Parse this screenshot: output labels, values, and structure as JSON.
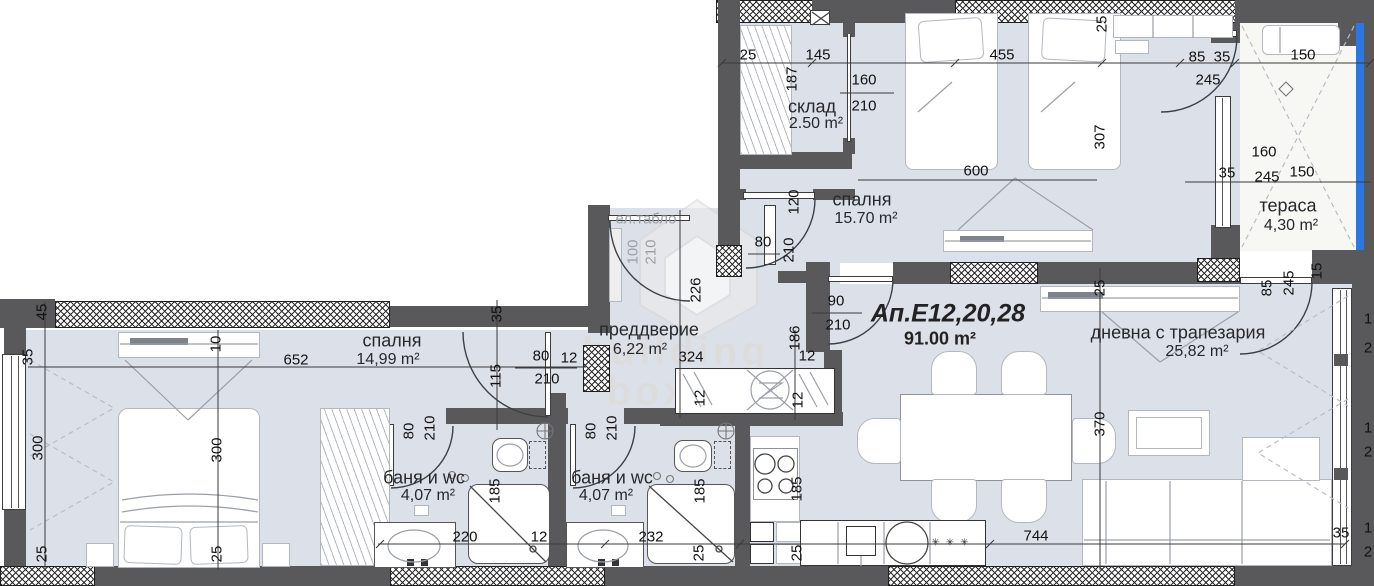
{
  "plan": {
    "apartment": {
      "label": "Ап.Е12,20,28",
      "area": "91.00 m²"
    },
    "rooms": [
      {
        "name": "склад",
        "area": "2.50 m²",
        "x": 812,
        "y": 107,
        "ax": 816,
        "ay": 124
      },
      {
        "name": "спалня",
        "area": "15.70 m²",
        "x": 862,
        "y": 200,
        "ax": 866,
        "ay": 219
      },
      {
        "name": "тераса",
        "area": "4,30 m²",
        "x": 1288,
        "y": 206,
        "ax": 1291,
        "ay": 226
      },
      {
        "name": "преддверие",
        "area": "6,22 m²",
        "x": 649,
        "y": 330,
        "ax": 640,
        "ay": 350
      },
      {
        "name": "дневна с трапезария",
        "area": "25,82 m²",
        "x": 1178,
        "y": 333,
        "ax": 1197,
        "ay": 352
      },
      {
        "name": "спалня",
        "area": "14,99 m²",
        "x": 392,
        "y": 341,
        "ax": 388,
        "ay": 360
      },
      {
        "name": "баня и wc",
        "area": "4,07 m²",
        "x": 424,
        "y": 478,
        "ax": 428,
        "ay": 496
      },
      {
        "name": "баня и wc",
        "area": "4,07 m²",
        "x": 612,
        "y": 478,
        "ax": 606,
        "ay": 496
      }
    ],
    "annotations": [
      {
        "text": "ел.табло",
        "x": 646,
        "y": 219
      }
    ],
    "watermark": {
      "line1": "building",
      "line2": "box"
    },
    "dimensions": [
      {
        "t": "25",
        "x": 748,
        "y": 55
      },
      {
        "t": "145",
        "x": 818,
        "y": 55
      },
      {
        "t": "187",
        "x": 792,
        "y": 79,
        "r": 1
      },
      {
        "t": "160",
        "x": 864,
        "y": 80
      },
      {
        "t": "210",
        "x": 864,
        "y": 106
      },
      {
        "t": "455",
        "x": 1002,
        "y": 55
      },
      {
        "t": "600",
        "x": 976,
        "y": 171
      },
      {
        "t": "85",
        "x": 1197,
        "y": 57
      },
      {
        "t": "35",
        "x": 1222,
        "y": 57
      },
      {
        "t": "245",
        "x": 1208,
        "y": 80
      },
      {
        "t": "150",
        "x": 1303,
        "y": 55
      },
      {
        "t": "25",
        "x": 1102,
        "y": 24,
        "r": 1
      },
      {
        "t": "307",
        "x": 1100,
        "y": 137,
        "r": 1
      },
      {
        "t": "160",
        "x": 1264,
        "y": 152
      },
      {
        "t": "35",
        "x": 1227,
        "y": 173
      },
      {
        "t": "245",
        "x": 1267,
        "y": 177
      },
      {
        "t": "150",
        "x": 1302,
        "y": 172
      },
      {
        "t": "120",
        "x": 794,
        "y": 202,
        "r": 1
      },
      {
        "t": "80",
        "x": 763,
        "y": 242
      },
      {
        "t": "210",
        "x": 789,
        "y": 250,
        "r": 1
      },
      {
        "t": "226",
        "x": 696,
        "y": 290,
        "r": 1
      },
      {
        "t": "100",
        "x": 633,
        "y": 252,
        "r": 1,
        "g": 1
      },
      {
        "t": "210",
        "x": 651,
        "y": 252,
        "r": 1,
        "g": 1
      },
      {
        "t": "90",
        "x": 836,
        "y": 301
      },
      {
        "t": "210",
        "x": 838,
        "y": 325
      },
      {
        "t": "186",
        "x": 795,
        "y": 338,
        "r": 1
      },
      {
        "t": "12",
        "x": 807,
        "y": 356
      },
      {
        "t": "12",
        "x": 798,
        "y": 400,
        "r": 1
      },
      {
        "t": "324",
        "x": 691,
        "y": 357
      },
      {
        "t": "12",
        "x": 700,
        "y": 398,
        "r": 1
      },
      {
        "t": "25",
        "x": 1100,
        "y": 288,
        "r": 1
      },
      {
        "t": "370",
        "x": 1100,
        "y": 424,
        "r": 1
      },
      {
        "t": "85",
        "x": 1267,
        "y": 288,
        "r": 1
      },
      {
        "t": "245",
        "x": 1289,
        "y": 283,
        "r": 1
      },
      {
        "t": "15",
        "x": 1317,
        "y": 271,
        "r": 1
      },
      {
        "t": "652",
        "x": 296,
        "y": 360
      },
      {
        "t": "10",
        "x": 216,
        "y": 344,
        "r": 1
      },
      {
        "t": "45",
        "x": 42,
        "y": 312,
        "r": 1
      },
      {
        "t": "35",
        "x": 28,
        "y": 357,
        "r": 1
      },
      {
        "t": "300",
        "x": 38,
        "y": 448,
        "r": 1
      },
      {
        "t": "300",
        "x": 217,
        "y": 450,
        "r": 1
      },
      {
        "t": "25",
        "x": 42,
        "y": 554,
        "r": 1
      },
      {
        "t": "25",
        "x": 217,
        "y": 554,
        "r": 1
      },
      {
        "t": "35",
        "x": 497,
        "y": 314,
        "r": 1
      },
      {
        "t": "115",
        "x": 496,
        "y": 376,
        "r": 1
      },
      {
        "t": "80",
        "x": 541,
        "y": 356
      },
      {
        "t": "12",
        "x": 569,
        "y": 358
      },
      {
        "t": "210",
        "x": 547,
        "y": 379
      },
      {
        "t": "80",
        "x": 409,
        "y": 431,
        "r": 1
      },
      {
        "t": "210",
        "x": 430,
        "y": 428,
        "r": 1
      },
      {
        "t": "80",
        "x": 591,
        "y": 431,
        "r": 1
      },
      {
        "t": "210",
        "x": 612,
        "y": 428,
        "r": 1
      },
      {
        "t": "185",
        "x": 495,
        "y": 491,
        "r": 1
      },
      {
        "t": "220",
        "x": 465,
        "y": 537
      },
      {
        "t": "12",
        "x": 539,
        "y": 537
      },
      {
        "t": "185",
        "x": 700,
        "y": 491,
        "r": 1
      },
      {
        "t": "232",
        "x": 651,
        "y": 537
      },
      {
        "t": "25",
        "x": 699,
        "y": 553,
        "r": 1
      },
      {
        "t": "185",
        "x": 797,
        "y": 489,
        "r": 1
      },
      {
        "t": "25",
        "x": 797,
        "y": 553,
        "r": 1
      },
      {
        "t": "744",
        "x": 1036,
        "y": 536
      },
      {
        "t": "35",
        "x": 1341,
        "y": 533
      },
      {
        "t": "1",
        "x": 1368,
        "y": 319
      },
      {
        "t": "2",
        "x": 1368,
        "y": 348
      },
      {
        "t": "1",
        "x": 1368,
        "y": 428
      },
      {
        "t": "2",
        "x": 1368,
        "y": 452
      },
      {
        "t": "1",
        "x": 1368,
        "y": 528
      },
      {
        "t": "2",
        "x": 1368,
        "y": 552
      }
    ]
  }
}
